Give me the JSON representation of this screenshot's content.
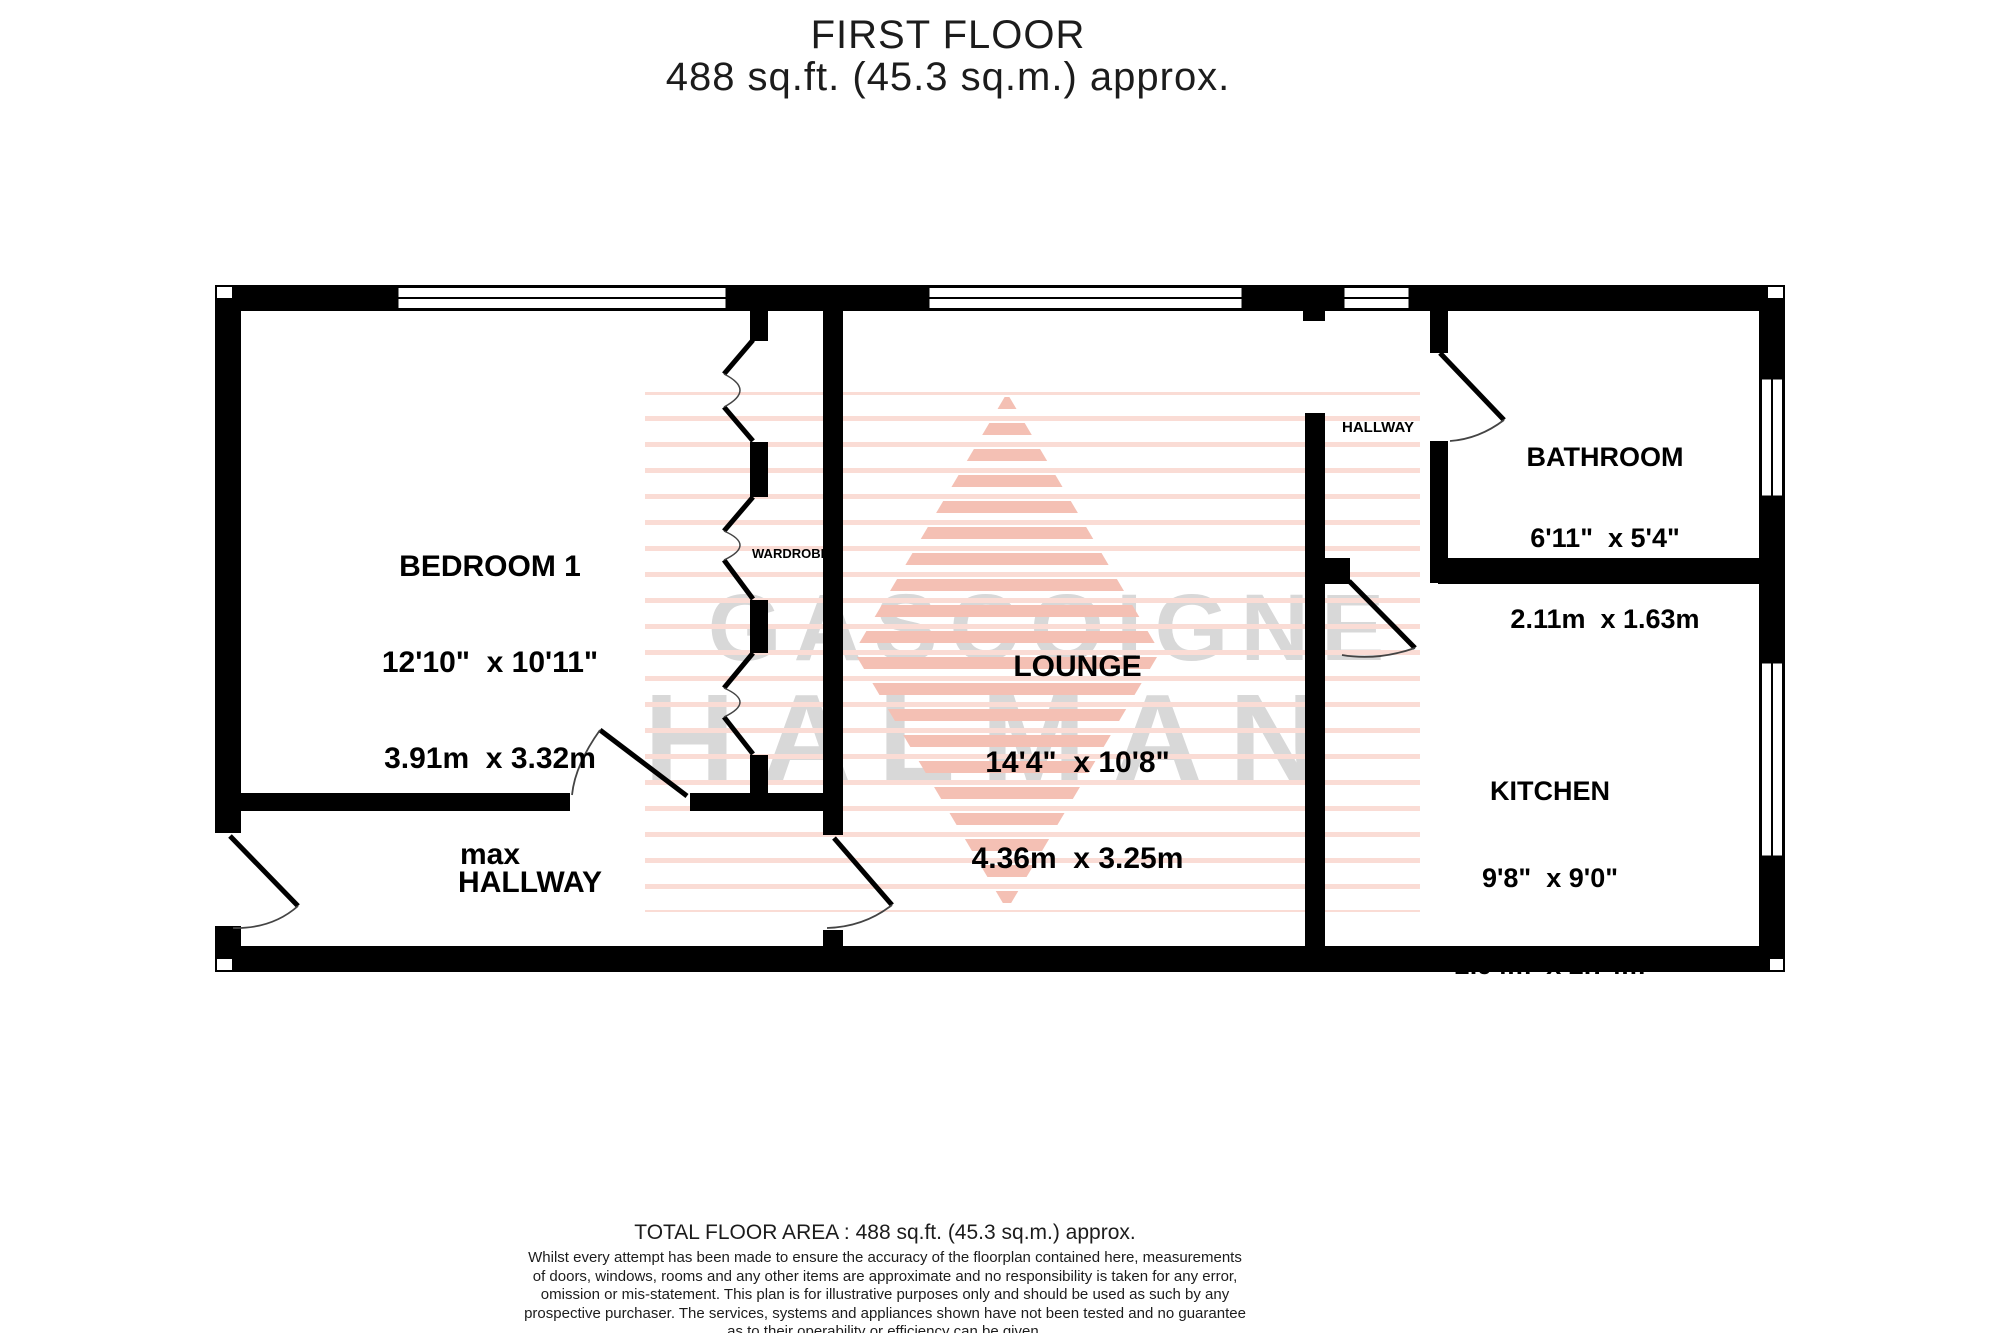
{
  "title": {
    "floor": "FIRST FLOOR",
    "area": "488 sq.ft. (45.3 sq.m.) approx."
  },
  "watermark": {
    "line1": "GASCOIGNE",
    "line2": "HALMAN"
  },
  "rooms": {
    "bedroom": {
      "name": "BEDROOM 1",
      "imperial": "12'10\"  x 10'11\"",
      "metric": "3.91m  x 3.32m",
      "note": "max"
    },
    "lounge": {
      "name": "LOUNGE",
      "imperial": "14'4\"  x 10'8\"",
      "metric": "4.36m  x 3.25m"
    },
    "bathroom": {
      "name": "BATHROOM",
      "imperial": "6'11\"  x 5'4\"",
      "metric": "2.11m  x 1.63m"
    },
    "kitchen": {
      "name": "KITCHEN",
      "imperial": "9'8\"  x 9'0\"",
      "metric": "2.94m  x 2.74m"
    },
    "hallway_main": {
      "name": "HALLWAY"
    },
    "hallway_upper": {
      "name": "HALLWAY"
    },
    "wardrobe": {
      "name": "WARDROBE"
    }
  },
  "footer": {
    "total_area": "TOTAL FLOOR AREA : 488 sq.ft. (45.3 sq.m.) approx.",
    "disclaimer_lines": [
      "Whilst every attempt has been made to ensure the accuracy of the floorplan contained here, measurements",
      "of doors, windows, rooms and any other items are approximate and no responsibility is taken for any error,",
      "omission or mis-statement. This plan is for illustrative purposes only and should be used as such by any",
      "prospective purchaser. The services, systems and appliances shown have not been tested and no guarantee",
      "as to their operability or efficiency can be given."
    ],
    "credit": "Made with Metropix ©2025"
  },
  "colors": {
    "wall": "#000000",
    "watermark_gray": "#d8d8d8",
    "stripe_light": "#fadcd5",
    "stripe_strong": "#f4c0b4",
    "door_arc": "#444444"
  }
}
